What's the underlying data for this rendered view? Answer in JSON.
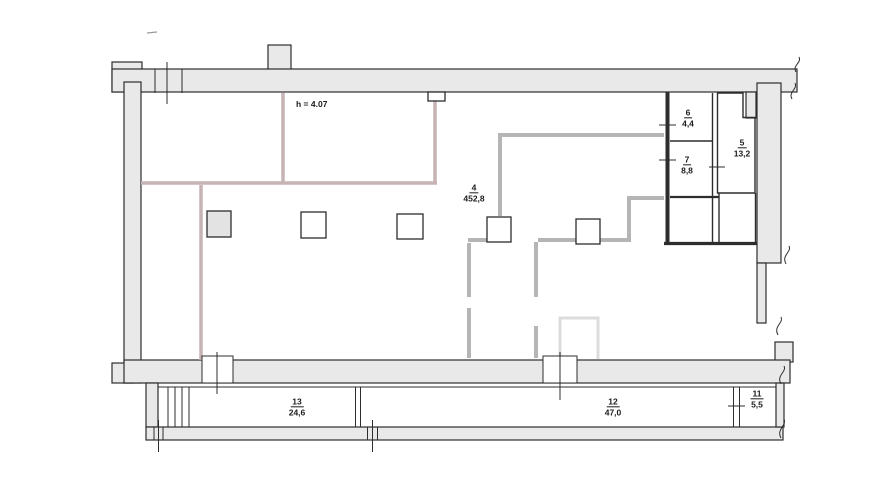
{
  "plan": {
    "height_note": "h = 4.07",
    "rooms": {
      "r4": {
        "number": "4",
        "area": "452,8"
      },
      "r5": {
        "number": "5",
        "area": "13,2"
      },
      "r6": {
        "number": "6",
        "area": "4,4"
      },
      "r7": {
        "number": "7",
        "area": "8,8"
      },
      "r11": {
        "number": "11",
        "area": "5,5"
      },
      "r12": {
        "number": "12",
        "area": "47,0"
      },
      "r13": {
        "number": "13",
        "area": "24,6"
      }
    },
    "colors": {
      "background": "#ffffff",
      "wall-fill": "#e9e9e9",
      "wall-stroke": "#2d2d2d",
      "partition-pink": "#c6b4b4",
      "partition-gray": "#b5b5b5",
      "partition-light": "#dcdcdc",
      "column-fill": "#e3e3e3",
      "text": "#1c1c1c"
    }
  }
}
